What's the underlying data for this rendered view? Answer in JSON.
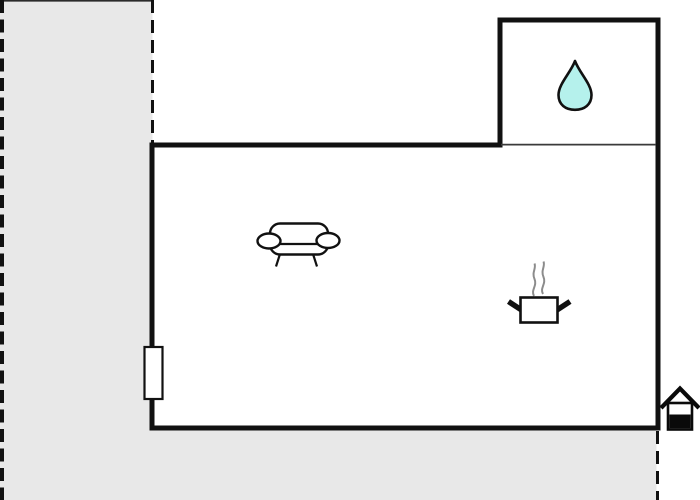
{
  "page": {
    "type": "floor-plan",
    "title": ""
  },
  "colors": {
    "background": "#ffffff",
    "surroundings": "#e8e8e8",
    "wall": "#111111",
    "partition": "#3a3a3a",
    "boundary": "#111111",
    "steam": "#8c8c8c",
    "water_drop": "#b5f1ec",
    "house_marker": "#0a0a0a",
    "window": "#ffffff"
  },
  "icons": {
    "bathroom": "water-drop-icon",
    "living_area": [
      "couch-icon",
      "cooking-pot-icon"
    ],
    "entrance": "entrance-house-icon",
    "window": "window-marker"
  }
}
